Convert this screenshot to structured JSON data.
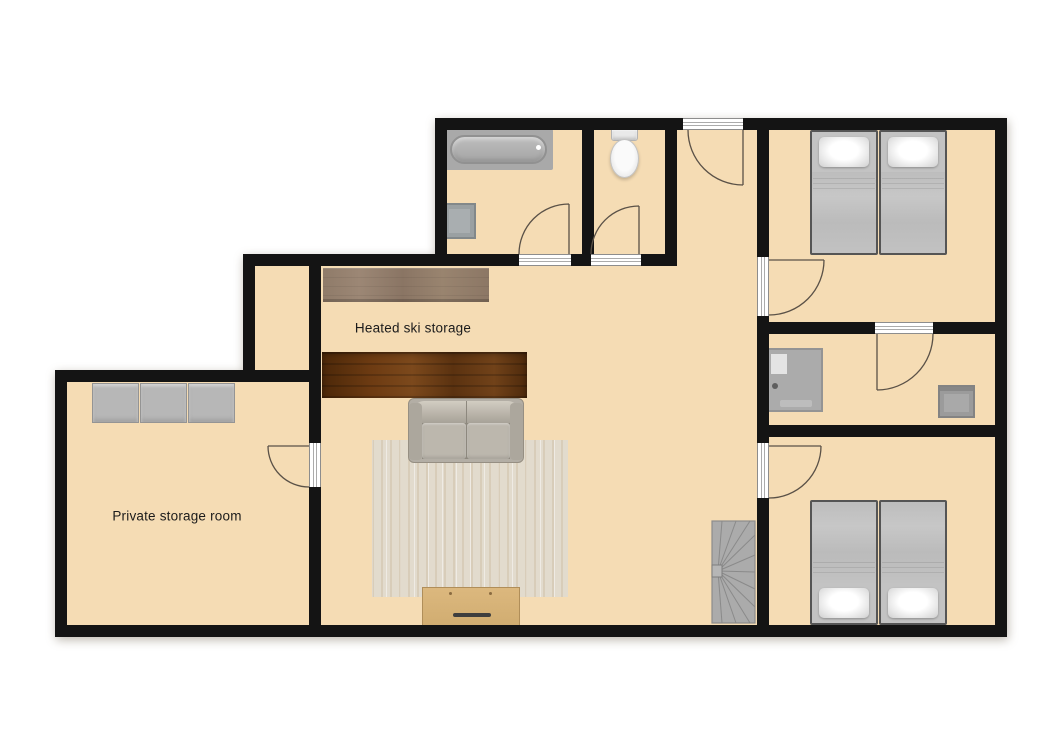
{
  "palette": {
    "floor": "#f5dcb4",
    "wall": "#141414",
    "page_bg": "#ffffff",
    "swing": "#5a5147",
    "label": "#1b1b1b"
  },
  "labels": {
    "ski_storage": "Heated ski storage",
    "private_storage": "Private storage room"
  },
  "rooms": [
    {
      "name": "heated-ski-storage",
      "label": "Heated ski storage",
      "furniture": [
        "wood-bench-light",
        "wood-bench-dark",
        "sofa",
        "rug",
        "sideboard"
      ]
    },
    {
      "name": "private-storage-room",
      "label": "Private storage room",
      "furniture": [
        "storage-cabinet",
        "storage-cabinet",
        "storage-cabinet"
      ]
    },
    {
      "name": "bathroom",
      "furniture": [
        "bathtub",
        "washbasin"
      ]
    },
    {
      "name": "wc",
      "furniture": [
        "toilet"
      ]
    },
    {
      "name": "bedroom-north",
      "furniture": [
        "single-bed",
        "single-bed"
      ]
    },
    {
      "name": "shower-room",
      "furniture": [
        "shower-unit",
        "washbasin"
      ]
    },
    {
      "name": "bedroom-south",
      "furniture": [
        "single-bed",
        "single-bed"
      ]
    },
    {
      "name": "hallway",
      "furniture": [
        "winder-staircase"
      ]
    }
  ]
}
